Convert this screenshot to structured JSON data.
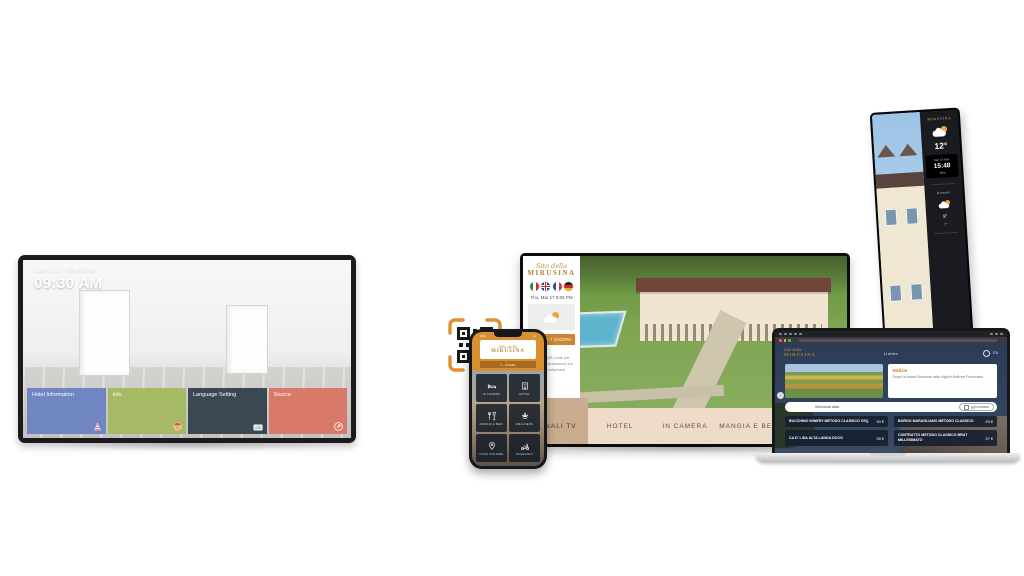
{
  "brand": {
    "script": "Sito della",
    "name": "MIRUSINA"
  },
  "colors": {
    "gold": "#b5832f",
    "navy": "#2e3e57",
    "tan_menu": "#eedcc8",
    "tan_active": "#c9ad8e",
    "orange_button": "#cd8730",
    "tile_blue": "#6f86c2",
    "tile_green": "#a6b964",
    "tile_dark": "#3a4854",
    "tile_red": "#d9796a"
  },
  "left_tv": {
    "date": "2014.03.17 / THURSDAY",
    "time": "09:30 AM",
    "tiles": [
      {
        "label": "Hotel Information",
        "icon": "party-cone-icon"
      },
      {
        "label": "Info",
        "icon": "bellboy-icon"
      },
      {
        "label": "Language Setting",
        "icon": "picture-flag-icon"
      },
      {
        "label": "Source",
        "icon": "source-arrow-icon"
      }
    ]
  },
  "phone": {
    "status_time": "9:41",
    "home_label": "HOME",
    "tiles": [
      {
        "label": "IN CAMERA",
        "icon": "bed-icon"
      },
      {
        "label": "HOTEL",
        "icon": "hotel-icon"
      },
      {
        "label": "MANGIA E BEVI",
        "icon": "dining-icon"
      },
      {
        "label": "WELLNESS",
        "icon": "spa-icon"
      },
      {
        "label": "COSA VISITARE",
        "icon": "map-pin-icon"
      },
      {
        "label": "NOLEGGIO",
        "icon": "scooter-icon"
      }
    ]
  },
  "big_tv": {
    "datetime": "Thu, Mar 17 8:05 PM",
    "languages": [
      "Italiano",
      "English",
      "Français",
      "Deutsch"
    ],
    "weather_button": "METEO 7 GIORNI",
    "qr_hint": "Leggi il QR Code per avere le informazioni sul tuo smartphone",
    "menu": [
      {
        "label": "CANALI TV",
        "active": true
      },
      {
        "label": "HOTEL",
        "active": false
      },
      {
        "label": "IN CAMERA",
        "active": false
      },
      {
        "label": "MANGIA E BEVI",
        "active": false
      },
      {
        "label": "WELLNESS",
        "active": false
      }
    ]
  },
  "totem": {
    "temp_now": "12°",
    "date": "Mar 14 Mar",
    "time": "15:48",
    "city": "Alba",
    "tomorrow_label": "Domani",
    "tomorrow_high": "9°",
    "tomorrow_low": "7°"
  },
  "laptop": {
    "nav_item": "Listino",
    "lang": "ITA",
    "news_title": "Notizie",
    "news_text": "Scopri la nostra Selezione delle Migliori Bollicine Piemontesi...",
    "search_label": "Seleziona data",
    "search_value": "gg/mm/aaaa",
    "wines": [
      {
        "name": "Bucchino Winery Metodo Classico VSQ",
        "price": "30 €"
      },
      {
        "name": "Borgo Maragliano Metodo Classico",
        "price": "29 €"
      },
      {
        "name": "Ca d' Lida Alta Langa DOCG",
        "price": "35 €"
      },
      {
        "name": "Contratto Metodo Classico Brut Millesimato",
        "price": "37 €"
      }
    ]
  }
}
